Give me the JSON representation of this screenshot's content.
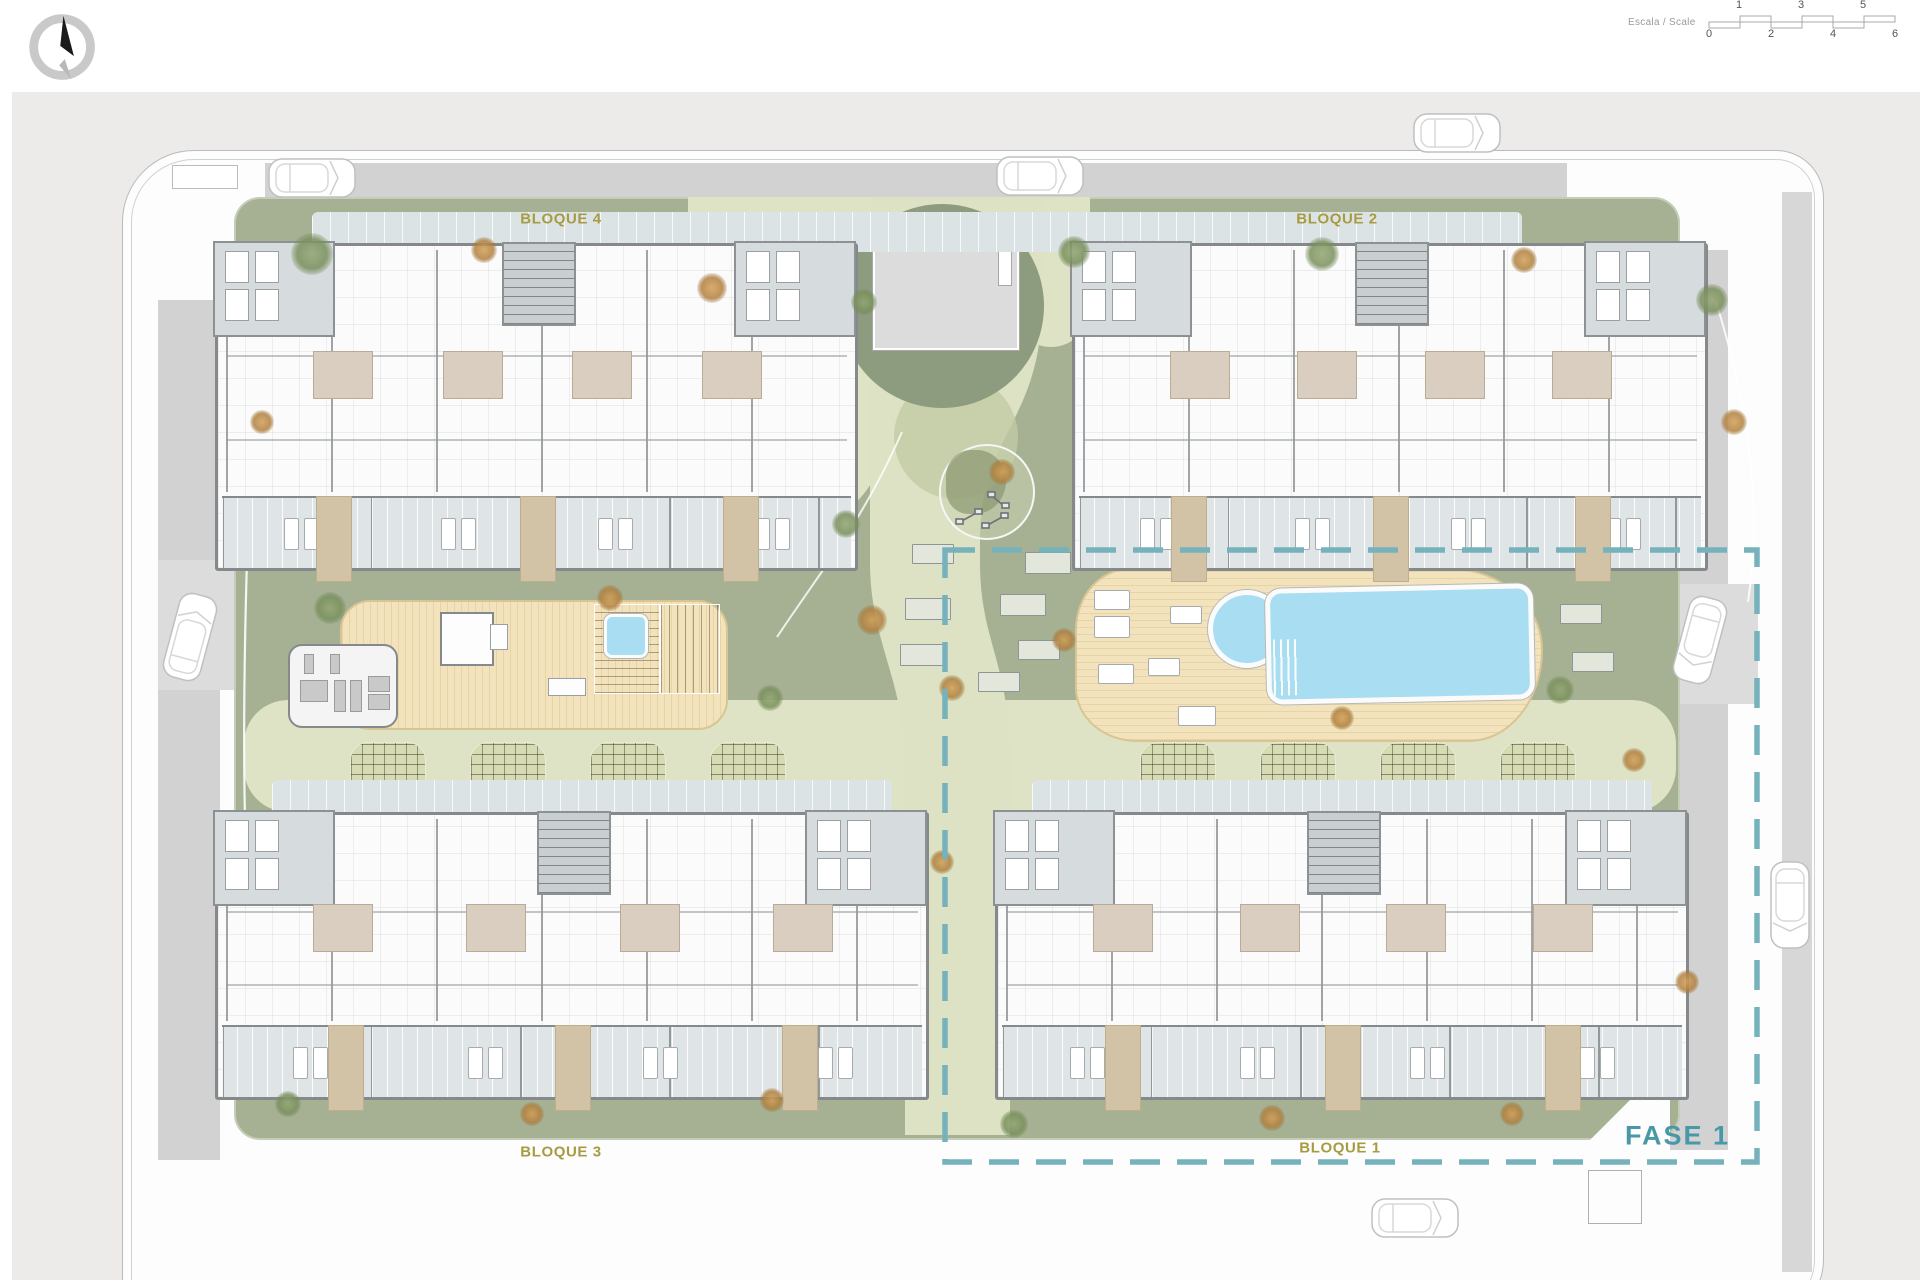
{
  "header": {
    "north_arrow": "north-arrow-icon",
    "scalebar": {
      "label": "Escala / Scale",
      "top_numbers": [
        "1",
        "3",
        "5"
      ],
      "bottom_numbers": [
        "0",
        "2",
        "4",
        "6"
      ]
    }
  },
  "plan": {
    "blocks": {
      "bloque1": "BLOQUE 1",
      "bloque2": "BLOQUE 2",
      "bloque3": "BLOQUE 3",
      "bloque4": "BLOQUE 4"
    },
    "phase": {
      "label": "FASE 1"
    },
    "features": [
      "main-pool",
      "kids-pool",
      "jacuzzi",
      "gym",
      "pavilion",
      "playground",
      "pergola-planters",
      "central-building"
    ]
  },
  "colors": {
    "block_label": "#a79b42",
    "phase_label": "#4898a8",
    "phase_dash": "#76b2bc",
    "pool_water": "#a9def2",
    "deck_wood": "#f3e3bc",
    "green_area": "#a6b193",
    "light_path": "#dde3c4",
    "road": "#d2d2d2",
    "terrace_tile": "#dfe5e7"
  }
}
